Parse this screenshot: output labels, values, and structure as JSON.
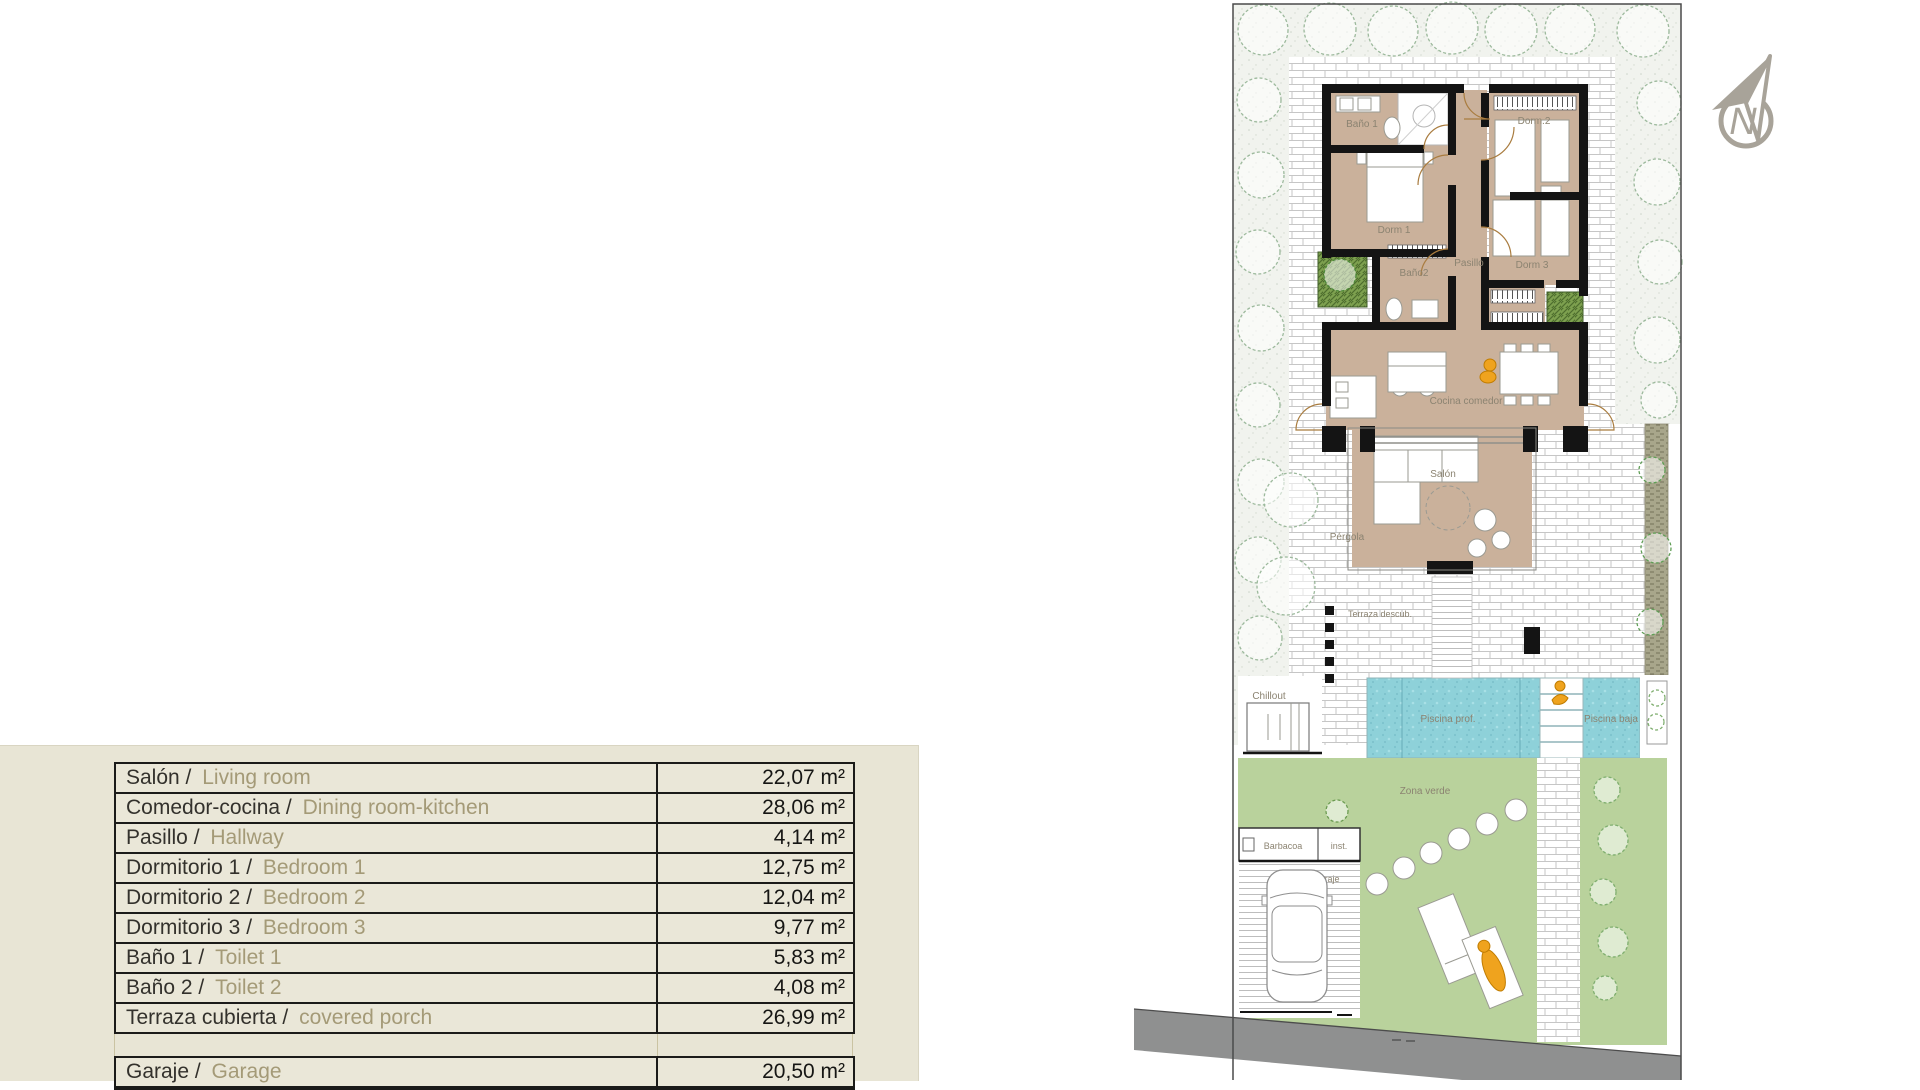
{
  "area_table": {
    "rows": [
      {
        "label_es": "Salón /",
        "label_en": "Living room",
        "value": "22,07 m²"
      },
      {
        "label_es": "Comedor-cocina /",
        "label_en": "Dining room-kitchen",
        "value": "28,06 m²"
      },
      {
        "label_es": "Pasillo /",
        "label_en": "Hallway",
        "value": "4,14 m²"
      },
      {
        "label_es": "Dormitorio 1 /",
        "label_en": "Bedroom 1",
        "value": "12,75 m²"
      },
      {
        "label_es": "Dormitorio 2 /",
        "label_en": "Bedroom 2",
        "value": "12,04 m²"
      },
      {
        "label_es": "Dormitorio 3 /",
        "label_en": "Bedroom 3",
        "value": "9,77 m²"
      },
      {
        "label_es": "Baño 1 /",
        "label_en": "Toilet 1",
        "value": "5,83 m²"
      },
      {
        "label_es": "Baño 2 /",
        "label_en": "Toilet 2",
        "value": "4,08 m²"
      },
      {
        "label_es": "Terraza cubierta /",
        "label_en": "covered porch",
        "value": "26,99 m²"
      }
    ],
    "extra_rows": [
      {
        "label_es": "Garaje /",
        "label_en": "Garage",
        "value": "20,50 m²"
      }
    ]
  },
  "plan": {
    "labels": {
      "bano1": "Baño 1",
      "dorm2": "Dorm.2",
      "dorm1": "Dorm 1",
      "bano2": "Baño2",
      "pasillo": "Pasillo",
      "dorm3": "Dorm 3",
      "cocina": "Cocina comedor",
      "salon": "Salón",
      "pergola": "Pérgola",
      "terraza": "Terraza descub.",
      "chillout": "Chillout",
      "piscina_prof": "Piscina prof.",
      "piscina_baja": "Piscina baja",
      "zona_verde": "Zona verde",
      "barbacoa": "Barbacoa",
      "inst": "inst.",
      "garaje": "Garaje",
      "north": "N"
    },
    "colors": {
      "room_floor": "#cab19b",
      "grass": "#b9d29c",
      "pool": "#8ed1d9",
      "road": "#8f9090",
      "wall": "#141414",
      "accent_person": "#efa31e",
      "label": "#8b8371"
    }
  }
}
